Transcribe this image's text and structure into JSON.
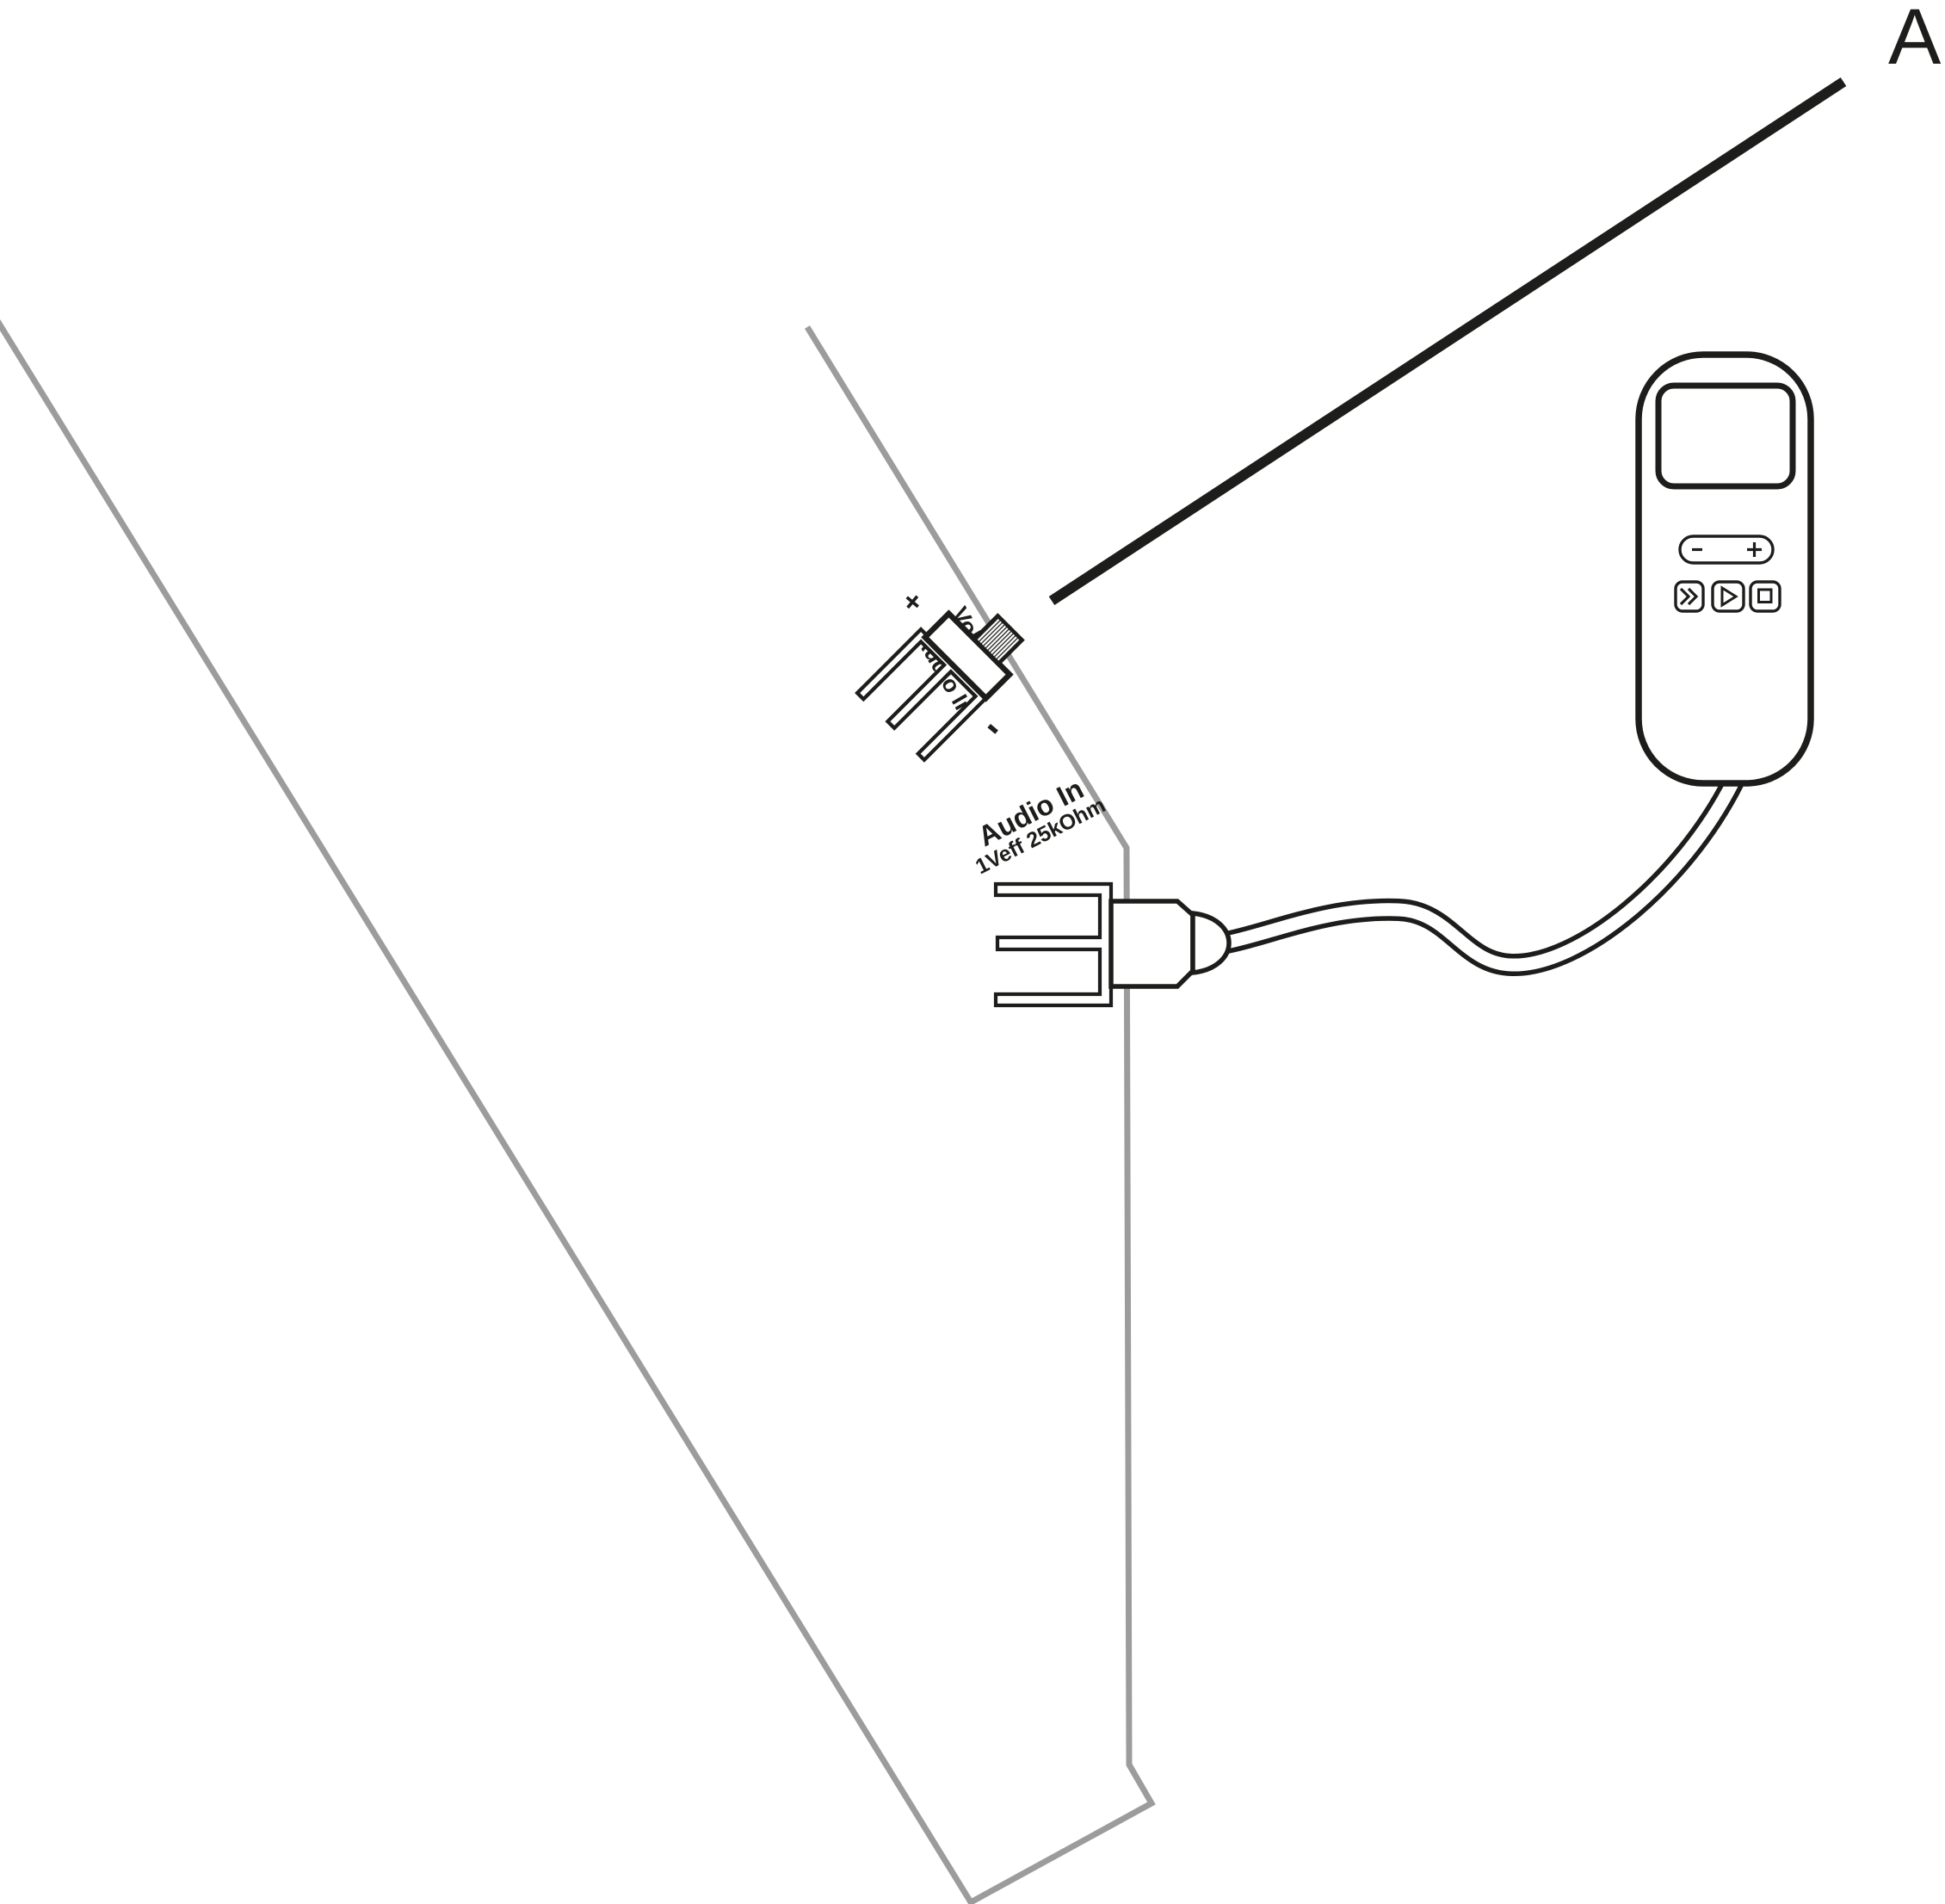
{
  "figure": {
    "label": "A"
  },
  "colors": {
    "ink": "#1d1d1b",
    "panel_gray": "#9c9c9c",
    "background": "#ffffff"
  },
  "switch_labels": {
    "plus": "+",
    "volume": "Volume",
    "audio_in": "Audio In",
    "minus": "-"
  },
  "connector": {
    "title": "Audio In",
    "spec": "1Veff  25kOhm"
  },
  "player": {
    "icons": {
      "volume_minus": "minus-icon",
      "volume_plus": "plus-icon",
      "fast_forward": "double-chevron-right-icon",
      "play": "triangle-right-outline-icon",
      "stop": "square-outline-icon"
    }
  }
}
